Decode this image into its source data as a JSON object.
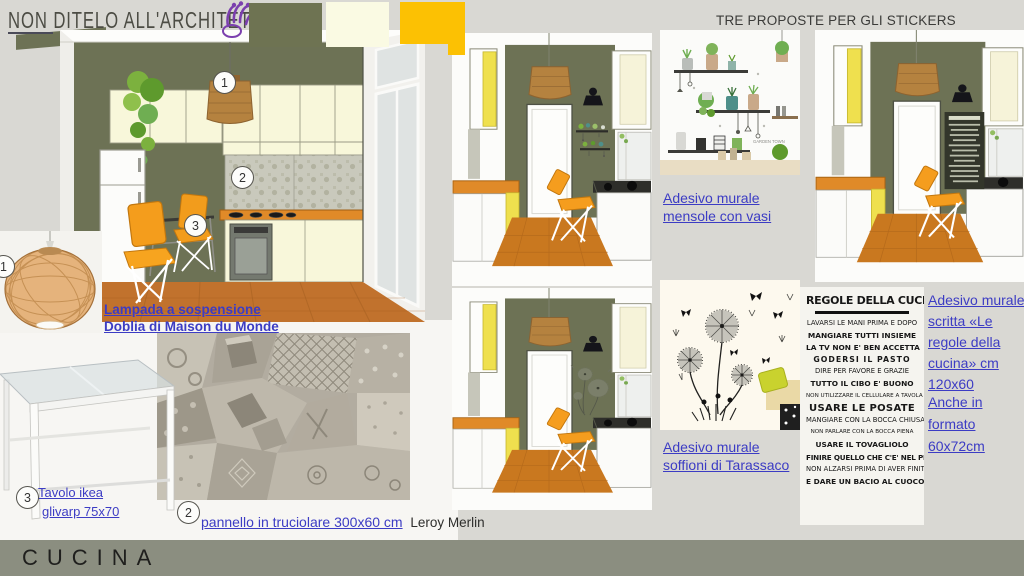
{
  "header": {
    "logo_text": "NON DITELO ALL'ARCHITETTO",
    "stickers_heading": "TRE PROPOSTE PER GLI STICKERS"
  },
  "footer": {
    "page_title": "CUCINA"
  },
  "callouts": {
    "one": "1",
    "two": "2",
    "three": "3"
  },
  "links": {
    "lamp_line1": "Lampada a sospensione",
    "lamp_line2": "Doblia di Maison du Monde",
    "shelf_line1": "Adesivo murale",
    "shelf_line2": "mensole con vasi",
    "dandelion_line1": "Adesivo murale",
    "dandelion_line2": "soffioni di Tarassaco",
    "rules_line1": "Adesivo murale",
    "rules_line2": "scritta «Le",
    "rules_line3": "regole della",
    "rules_line4": "cucina» cm",
    "rules_line5": "120x60",
    "alt_format_line1": "Anche in",
    "alt_format_line2": "formato",
    "alt_format_line3": "60x72cm",
    "table_line1": "Tavolo ikea",
    "table_line2": "glivarp 75x70",
    "panel_link_text": "pannello in truciolare 300x60 cm",
    "panel_suffix": "Leroy Merlin"
  },
  "poster": {
    "title": "REGOLE DELLA CUCINA",
    "lines": [
      "LAVARSI LE MANI PRIMA E DOPO",
      "MANGIARE TUTTI INSIEME",
      "LA TV NON E' BEN ACCETTA",
      "GODERSI IL PASTO",
      "DIRE PER FAVORE E GRAZIE",
      "TUTTO IL CIBO E' BUONO",
      "NON UTILIZZARE IL CELLULARE A TAVOLA",
      "USARE LE POSATE",
      "MANGIARE CON LA BOCCA CHIUSA",
      "NON PARLARE CON LA BOCCA PIENA",
      "USARE IL TOVAGLIOLO",
      "FINIRE QUELLO CHE C'E' NEL PIATTO",
      "NON ALZARSI PRIMA DI AVER FINITO",
      "E DARE UN BACIO AL CUOCO"
    ]
  },
  "sticker_shelf_caption": "GARDEN TOWN",
  "colors": {
    "wall_olive": "#6d7255",
    "swatch_olive": "#6e7352",
    "swatch_cream": "#fafae3",
    "swatch_yellow": "#fcc103",
    "counter_orange": "#e08a28",
    "chair_orange": "#f49d1c",
    "floor_terracotta": "#c1722d",
    "link_blue": "#3c3cc4",
    "footer_band": "#8b8e80",
    "pendant_rattan": "#b5823f"
  }
}
